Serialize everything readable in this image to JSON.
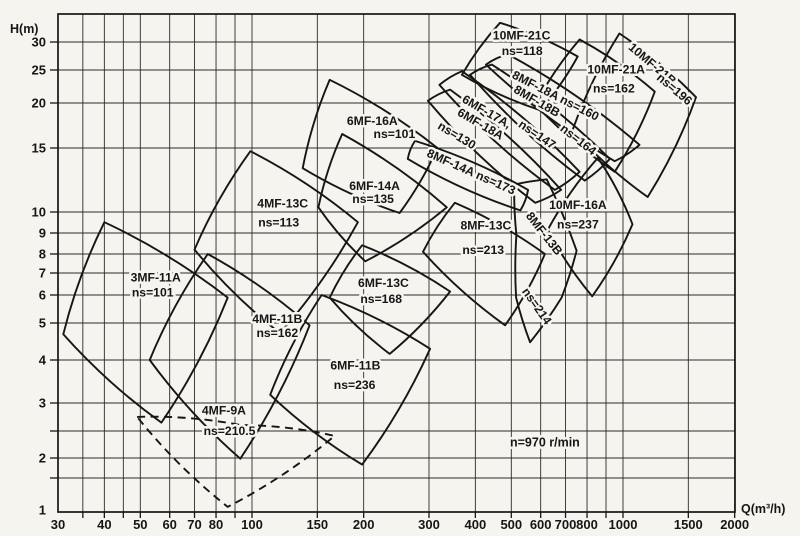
{
  "page": {
    "background": "#f5f4ef",
    "ink": "#161616",
    "grid_color": "#2b2b2b"
  },
  "chart_data": {
    "type": "area",
    "title": "",
    "description": "Pump selection range chart: head H vs capacity Q, log-log grid, overlapping model application regions",
    "speed_note": "n=970 r/min",
    "annotation": {
      "text": "n=970 r/min",
      "q": 616,
      "h": 2.2
    },
    "x_axis": {
      "label": "Q(m³/h)",
      "scale": "log",
      "range": [
        30,
        2000
      ],
      "tick_labels": [
        30,
        40,
        50,
        60,
        70,
        80,
        100,
        150,
        200,
        300,
        400,
        500,
        600,
        700,
        800,
        1000,
        1500,
        2000
      ],
      "gridlines": [
        35,
        40,
        45,
        50,
        60,
        70,
        80,
        90,
        100,
        150,
        200,
        300,
        400,
        500,
        600,
        700,
        800,
        900,
        1000,
        1500,
        2000
      ]
    },
    "y_axis": {
      "label": "H(m)",
      "scale": "log",
      "range": [
        1,
        36
      ],
      "tick_labels": [
        30,
        25,
        20,
        15,
        10,
        9,
        8,
        7,
        6,
        5,
        4,
        3,
        2,
        1
      ],
      "gridlines": [
        1.5,
        2,
        2.5,
        3,
        4,
        5,
        6,
        7,
        8,
        9,
        10,
        15,
        20,
        25,
        30
      ],
      "calibration": [
        [
          1,
          510
        ],
        [
          1.5,
          478
        ],
        [
          2,
          458
        ],
        [
          2.5,
          431
        ],
        [
          3,
          403
        ],
        [
          4,
          360
        ],
        [
          5,
          323
        ],
        [
          6,
          295
        ],
        [
          7,
          273
        ],
        [
          8,
          254
        ],
        [
          9,
          233
        ],
        [
          10,
          212
        ],
        [
          15,
          148
        ],
        [
          20,
          103
        ],
        [
          25,
          70
        ],
        [
          30,
          42
        ]
      ]
    },
    "layout": {
      "x0": 58,
      "x1": 735,
      "y_top": 14,
      "y_bot": 512,
      "q0": 30,
      "px_per_decade": 371,
      "y_upper_px_per_decade": 354
    },
    "regions": [
      {
        "name": "3MF-11A",
        "ns": "ns=101",
        "dashed": false,
        "points": [
          [
            40,
            9.5
          ],
          [
            86,
            5.9
          ],
          [
            57,
            2.64
          ],
          [
            31,
            4.67
          ]
        ],
        "labels": [
          {
            "t": "3MF-11A",
            "q": 55,
            "h": 6.6,
            "r": 0
          },
          {
            "t": "ns=101",
            "q": 54,
            "h": 5.95,
            "r": 0
          }
        ]
      },
      {
        "name": "4MF-9A",
        "ns": "ns=210.5",
        "dashed": true,
        "points": [
          [
            49,
            2.74
          ],
          [
            93,
            2.6
          ],
          [
            167,
            2.4
          ],
          [
            86,
            1.04
          ]
        ],
        "labels": [
          {
            "t": "4MF-9A",
            "q": 84,
            "h": 2.78,
            "r": 0
          },
          {
            "t": "ns=210.5",
            "q": 87,
            "h": 2.42,
            "r": 0
          }
        ]
      },
      {
        "name": "4MF-11B",
        "ns": "ns=162",
        "dashed": false,
        "points": [
          [
            76,
            8.0
          ],
          [
            143,
            4.93
          ],
          [
            93,
            1.98
          ],
          [
            53,
            4.0
          ]
        ],
        "labels": [
          {
            "t": "4MF-11B",
            "q": 117,
            "h": 5.0,
            "r": 0
          },
          {
            "t": "ns=162",
            "q": 117,
            "h": 4.6,
            "r": 0
          }
        ]
      },
      {
        "name": "4MF-13C",
        "ns": "ns=113",
        "dashed": false,
        "points": [
          [
            99,
            14.7
          ],
          [
            193,
            9.5
          ],
          [
            119,
            4.7
          ],
          [
            70,
            8.2
          ]
        ],
        "labels": [
          {
            "t": "4MF-13C",
            "q": 121,
            "h": 10.3,
            "r": 0
          },
          {
            "t": "ns=113",
            "q": 118,
            "h": 9.3,
            "r": 0
          }
        ]
      },
      {
        "name": "6MF-16A",
        "ns": "ns=101",
        "dashed": false,
        "points": [
          [
            162,
            23.4
          ],
          [
            316,
            15.0
          ],
          [
            250,
            9.95
          ],
          [
            137,
            13.2
          ]
        ],
        "labels": [
          {
            "t": "6MF-16A",
            "q": 211,
            "h": 17.4,
            "r": 0
          },
          {
            "t": "ns=101",
            "q": 242,
            "h": 16.0,
            "r": 0
          }
        ]
      },
      {
        "name": "6MF-14A",
        "ns": "ns=135",
        "dashed": false,
        "points": [
          [
            175,
            16.4
          ],
          [
            335,
            10.3
          ],
          [
            202,
            7.6
          ],
          [
            151,
            10.3
          ]
        ],
        "labels": [
          {
            "t": "6MF-14A",
            "q": 214,
            "h": 11.5,
            "r": 0
          },
          {
            "t": "ns=135",
            "q": 212,
            "h": 10.6,
            "r": 0
          }
        ]
      },
      {
        "name": "6MF-13C",
        "ns": "ns=168",
        "dashed": false,
        "points": [
          [
            198,
            8.4
          ],
          [
            342,
            6.15
          ],
          [
            235,
            4.15
          ],
          [
            162,
            5.9
          ]
        ],
        "labels": [
          {
            "t": "6MF-13C",
            "q": 226,
            "h": 6.35,
            "r": 0
          },
          {
            "t": "ns=168",
            "q": 223,
            "h": 5.7,
            "r": 0
          }
        ]
      },
      {
        "name": "6MF-11B",
        "ns": "ns=236",
        "dashed": false,
        "points": [
          [
            154,
            6.0
          ],
          [
            302,
            4.28
          ],
          [
            198,
            1.82
          ],
          [
            112,
            3.17
          ]
        ],
        "labels": [
          {
            "t": "6MF-11B",
            "q": 190,
            "h": 3.75,
            "r": 0
          },
          {
            "t": "ns=236",
            "q": 189,
            "h": 3.3,
            "r": 0
          }
        ]
      },
      {
        "name": "8MF-13C",
        "ns": "ns=213",
        "dashed": false,
        "points": [
          [
            352,
            10.6
          ],
          [
            616,
            8.0
          ],
          [
            481,
            4.93
          ],
          [
            289,
            8.1
          ]
        ],
        "labels": [
          {
            "t": "8MF-13C",
            "q": 427,
            "h": 9.15,
            "r": 0
          },
          {
            "t": "ns=213",
            "q": 420,
            "h": 8.0,
            "r": 0
          }
        ]
      },
      {
        "name": "8MF-13B",
        "ns": "ns=214",
        "dashed": false,
        "points": [
          [
            509,
            11.9
          ],
          [
            623,
            12.3
          ],
          [
            750,
            8.15
          ],
          [
            683,
            5.9
          ],
          [
            562,
            4.45
          ],
          [
            515,
            5.9
          ],
          [
            516,
            8.9
          ]
        ],
        "labels": [
          {
            "t": "8MF-13B",
            "q": 601,
            "h": 8.85,
            "r": 52
          },
          {
            "t": "ns=214",
            "q": 574,
            "h": 5.5,
            "r": 55
          }
        ]
      },
      {
        "name": "10MF-16A",
        "ns": "ns=237",
        "dashed": false,
        "points": [
          [
            856,
            14.1
          ],
          [
            1061,
            9.4
          ],
          [
            826,
            5.95
          ],
          [
            627,
            9.15
          ]
        ],
        "labels": [
          {
            "t": "10MF-16A",
            "q": 756,
            "h": 10.2,
            "r": 0
          },
          {
            "t": "ns=237",
            "q": 756,
            "h": 9.2,
            "r": 0
          }
        ]
      },
      {
        "name": "8MF-14A",
        "ns": "ns=173",
        "dashed": false,
        "points": [
          [
            275,
            15.7
          ],
          [
            555,
            11.5
          ],
          [
            529,
            10.1
          ],
          [
            263,
            14.0
          ]
        ],
        "labels": [
          {
            "t": "8MF-14A ns=173",
            "q": 386,
            "h": 12.6,
            "r": 24
          }
        ]
      },
      {
        "name": "6MF-18A",
        "ns": "ns=130",
        "dashed": false,
        "points": [
          [
            298,
            20.3
          ],
          [
            342,
            21.9
          ],
          [
            681,
            11.5
          ],
          [
            580,
            10.6
          ]
        ],
        "labels": [
          {
            "t": "6MF-18A",
            "q": 408,
            "h": 17.1,
            "r": 30
          },
          {
            "t": "ns=130",
            "q": 352,
            "h": 15.9,
            "r": 31
          }
        ]
      },
      {
        "name": "6MF-17A",
        "ns": "ns=147",
        "dashed": false,
        "points": [
          [
            320,
            22.6
          ],
          [
            368,
            24.8
          ],
          [
            764,
            12.9
          ],
          [
            655,
            11.5
          ]
        ],
        "labels": [
          {
            "t": "6MF-17A,",
            "q": 424,
            "h": 18.5,
            "r": 30
          },
          {
            "t": "ns=147",
            "q": 579,
            "h": 16.0,
            "r": 34
          }
        ]
      },
      {
        "name": "8MF-18B",
        "ns": "ns=164",
        "dashed": false,
        "points": [
          [
            387,
            24.2
          ],
          [
            443,
            25.9
          ],
          [
            922,
            14.0
          ],
          [
            789,
            12.2
          ]
        ],
        "labels": [
          {
            "t": "8MF-18B",
            "q": 579,
            "h": 19.8,
            "r": 30
          },
          {
            "t": "ns=164",
            "q": 746,
            "h": 15.5,
            "r": 38
          }
        ]
      },
      {
        "name": "8MF-18A",
        "ns": "ns=160",
        "dashed": false,
        "points": [
          [
            427,
            25.9
          ],
          [
            489,
            27.7
          ],
          [
            1108,
            15.3
          ],
          [
            950,
            13.8
          ]
        ],
        "labels": [
          {
            "t": "8MF-18A ns=160",
            "q": 651,
            "h": 20.5,
            "r": 27
          }
        ]
      },
      {
        "name": "10MF-21C",
        "ns": "ns=118",
        "dashed": false,
        "points": [
          [
            466,
            34
          ],
          [
            755,
            27.3
          ],
          [
            598,
            19.1
          ],
          [
            368,
            24.2
          ]
        ],
        "labels": [
          {
            "t": "10MF-21C",
            "q": 533,
            "h": 30.5,
            "r": 0
          },
          {
            "t": "ns=118",
            "q": 535,
            "h": 27.6,
            "r": 0
          }
        ]
      },
      {
        "name": "10MF-21A",
        "ns": "ns=162",
        "dashed": false,
        "points": [
          [
            764,
            30.5
          ],
          [
            1218,
            21.6
          ],
          [
            950,
            12.9
          ],
          [
            580,
            19.8
          ]
        ],
        "labels": [
          {
            "t": "10MF-21A",
            "q": 959,
            "h": 24.4,
            "r": 0
          },
          {
            "t": "ns=162",
            "q": 945,
            "h": 21.5,
            "r": 0
          }
        ]
      },
      {
        "name": "10MF-21B",
        "ns": "ns=196",
        "dashed": false,
        "points": [
          [
            978,
            31.7
          ],
          [
            1573,
            20.8
          ],
          [
            1166,
            11.0
          ],
          [
            731,
            16.8
          ]
        ],
        "labels": [
          {
            "t": "10MF-21B",
            "q": 1181,
            "h": 25.5,
            "r": 40
          },
          {
            "t": "ns=196",
            "q": 1355,
            "h": 21.5,
            "r": 40
          }
        ]
      }
    ]
  }
}
